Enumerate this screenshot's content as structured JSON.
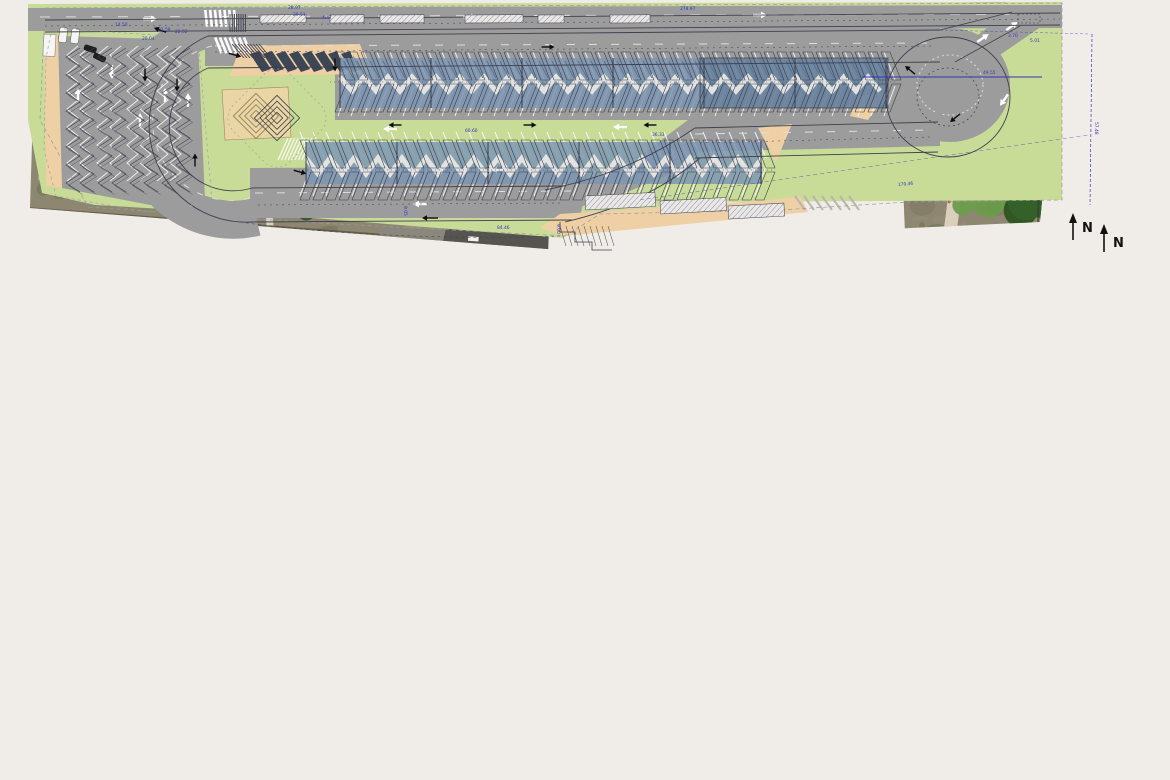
{
  "labels": {
    "north": "N"
  },
  "colors": {
    "page_bg": "#f0ede8",
    "aerial": {
      "ground": "#8d8670",
      "ground_dark": "#716c55",
      "ground_light": "#a89f85",
      "scrub": "#6b6f4c",
      "tree_dark": "#35612a",
      "tree_mid": "#4e7c38",
      "tree_light": "#6d9c4b",
      "path": "#ddd3bf",
      "road_top": "#b3ab9c",
      "asphalt": "#56544f",
      "boundary": "#3a382c",
      "wall": "#6a5a42",
      "flag": "#c25a32",
      "car_white": "#f2f2ee"
    },
    "plan": {
      "grass": "#c8db97",
      "road": "#9c9c9c",
      "road_edge": "#7b7b78",
      "sidewalk": "#eed0a4",
      "sand": "#e9d6a4",
      "sand_edge": "#9b8a64",
      "canopy_blue": "#7d96b3",
      "canopy_blue_dark": "#5a7390",
      "canopy_dark": "#3c4654",
      "marking": "#ffffff",
      "dash": "#dededa",
      "car_dark": "#1f1f1f",
      "car_white": "#f5f5f2"
    },
    "cad": {
      "line": "#3f3f4e",
      "line_light": "#9a9aa6",
      "dim": "#3535b5",
      "arrow": "#0d0d0d",
      "hatch": "#8e8e9a"
    }
  },
  "cad_dimensions": [
    {
      "t": "28.97",
      "x": 288,
      "y": 9,
      "r": 0
    },
    {
      "t": "29.51",
      "x": 293,
      "y": 16,
      "r": 0
    },
    {
      "t": "4.47",
      "x": 322,
      "y": 19,
      "r": 0
    },
    {
      "t": "278.97",
      "x": 680,
      "y": 10,
      "r": 0
    },
    {
      "t": "14.50",
      "x": 115,
      "y": 26,
      "r": 0
    },
    {
      "t": "20.04",
      "x": 142,
      "y": 40,
      "r": 0
    },
    {
      "t": "32.58",
      "x": 158,
      "y": 31,
      "r": 0
    },
    {
      "t": "22.52",
      "x": 175,
      "y": 33,
      "r": 0
    },
    {
      "t": "3.70",
      "x": 1008,
      "y": 37,
      "r": 0
    },
    {
      "t": "5.01",
      "x": 1030,
      "y": 42,
      "r": 0
    },
    {
      "t": "49.55",
      "x": 983,
      "y": 74,
      "r": 0
    },
    {
      "t": "57.48",
      "x": 1095,
      "y": 122,
      "r": 90
    },
    {
      "t": "60.60",
      "x": 465,
      "y": 132,
      "r": 0
    },
    {
      "t": "36.33",
      "x": 652,
      "y": 136,
      "r": 0
    },
    {
      "t": "9.05",
      "x": 404,
      "y": 206,
      "r": 90
    },
    {
      "t": "9.00",
      "x": 557,
      "y": 224,
      "r": 90
    },
    {
      "t": "84.46",
      "x": 497,
      "y": 229,
      "r": 0
    },
    {
      "t": "170.46",
      "x": 898,
      "y": 186,
      "r": -5
    }
  ]
}
